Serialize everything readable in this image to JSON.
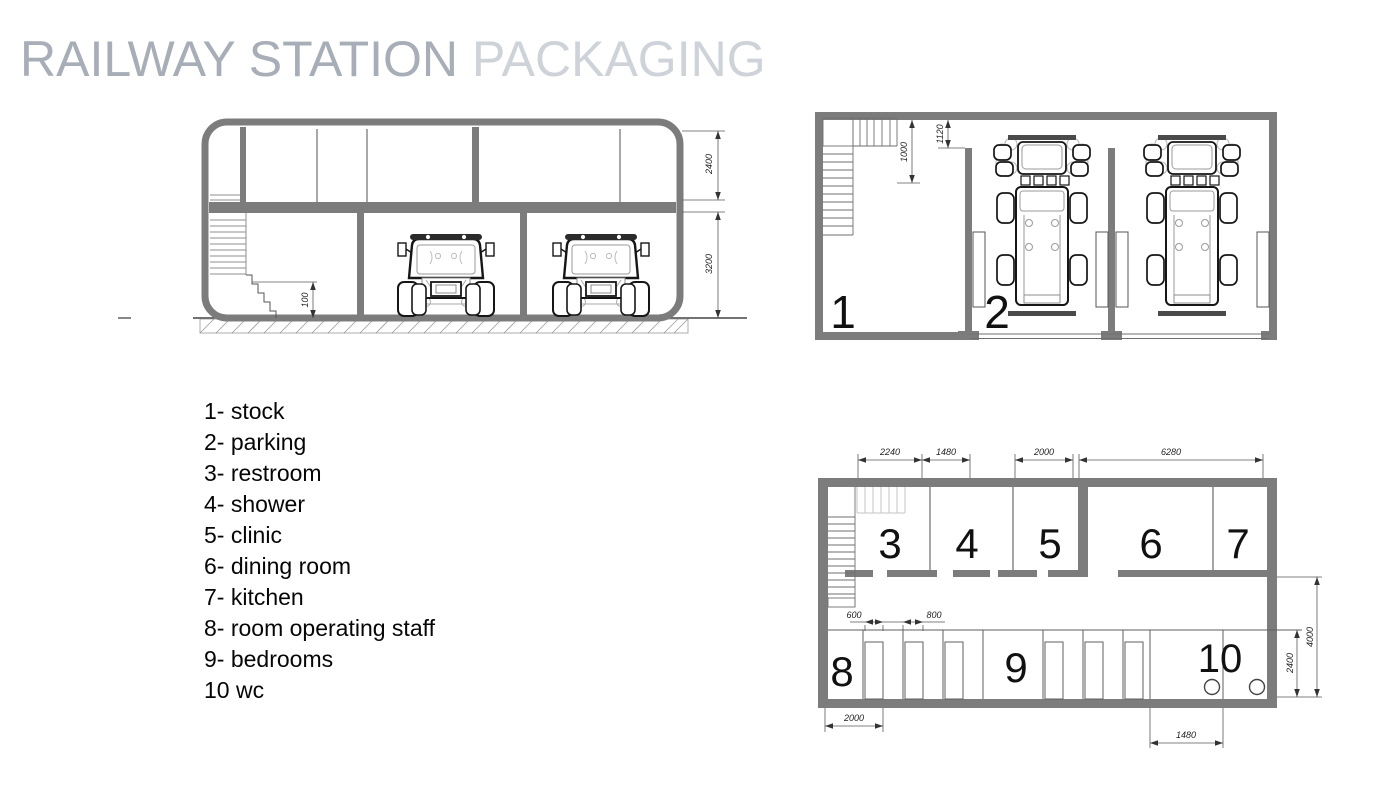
{
  "title": {
    "primary": "RAILWAY STATION",
    "secondary": "PACKAGING"
  },
  "legend": {
    "items": [
      "1- stock",
      "2- parking",
      "3- restroom",
      "4- shower",
      "5- clinic",
      "6- dining room",
      "7- kitchen",
      "8- room operating staff",
      "9- bedrooms",
      "10 wc"
    ]
  },
  "section": {
    "dim_upper_height": "2400",
    "dim_lower_height": "3200",
    "dim_plinth": "100"
  },
  "plan_parking": {
    "room_stock": "1",
    "room_parking": "2",
    "dim_stair": "1000",
    "dim_entry": "1120"
  },
  "plan_rooms": {
    "room_restroom": "3",
    "room_shower": "4",
    "room_clinic": "5",
    "room_dining": "6",
    "room_kitchen": "7",
    "room_staff": "8",
    "room_bedrooms": "9",
    "room_wc": "10",
    "dim_top_restroom": "2240",
    "dim_top_shower": "1480",
    "dim_top_clinic": "2000",
    "dim_top_dining": "6280",
    "dim_bed_width": "600",
    "dim_bed_gap": "800",
    "dim_bottom_left": "2000",
    "dim_bottom_right": "1480",
    "dim_row_depth": "2400",
    "dim_wing_depth": "4000"
  },
  "colors": {
    "wall": "#7c7c7c",
    "title_primary": "#a7aeb7",
    "title_secondary": "#ced3da",
    "line_dark": "#1a1a1a",
    "line_dim": "#5a5a5a"
  }
}
